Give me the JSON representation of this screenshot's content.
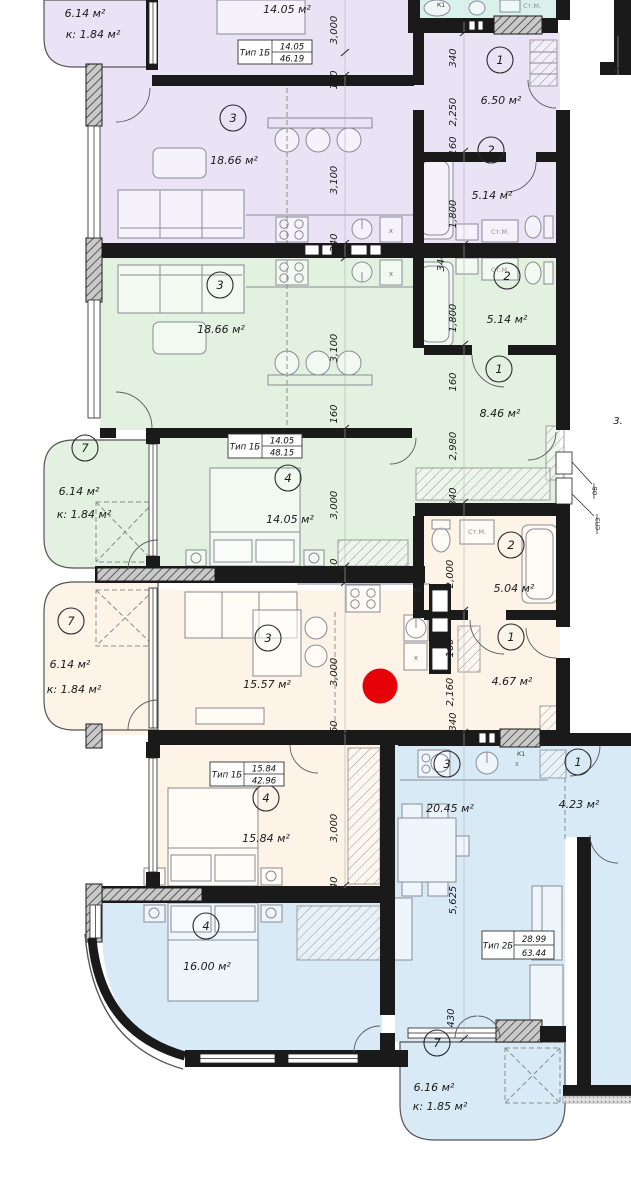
{
  "marker": {
    "color": "#e60008"
  },
  "palette": {
    "purple": "#eae3f6",
    "teal": "#daf0ea",
    "green": "#e3f1e1",
    "cream": "#fdf3e7",
    "blue": "#d9eaf7",
    "wall": "#1a1a1a"
  },
  "apartments": {
    "purple": {
      "type_table": {
        "name": "Тип 1Б",
        "area": "14.05",
        "total": "46.19"
      },
      "rooms": {
        "bedroom": {
          "area": "14.05 м²"
        },
        "living": {
          "num": "3",
          "area": "18.66 м²"
        },
        "hall": {
          "num": "1",
          "area": "6.50 м²"
        },
        "bath": {
          "num": "2",
          "area": "5.14 м²"
        }
      },
      "balcony": {
        "area": "6.14 м²",
        "coef": "к: 1.84 м²"
      }
    },
    "green": {
      "type_table": {
        "name": "Тип 1Б",
        "area": "14.05",
        "total": "48.15"
      },
      "rooms": {
        "living": {
          "num": "3",
          "area": "18.66 м²"
        },
        "bath": {
          "num": "2",
          "area": "5.14 м²"
        },
        "hall": {
          "num": "1",
          "area": "8.46 м²"
        },
        "bedroom": {
          "num": "4",
          "area": "14.05 м²"
        }
      },
      "balcony": {
        "num": "7",
        "area": "6.14 м²",
        "coef": "к: 1.84 м²"
      }
    },
    "cream": {
      "type_table": {
        "name": "Тип 1Б",
        "area": "15.84",
        "total": "42.96"
      },
      "rooms": {
        "living": {
          "num": "3",
          "area": "15.57 м²"
        },
        "bath": {
          "num": "2",
          "area": "5.04 м²"
        },
        "hall": {
          "num": "1",
          "area": "4.67 м²"
        },
        "bedroom": {
          "num": "4",
          "area": "15.84 м²"
        }
      },
      "balcony": {
        "num": "7",
        "area": "6.14 м²",
        "coef": "к: 1.84 м²"
      }
    },
    "blue": {
      "type_table": {
        "name": "Тип 2Б",
        "area": "28.99",
        "total": "63.44"
      },
      "rooms": {
        "bedroom": {
          "num": "4",
          "area": "16.00 м²"
        },
        "living": {
          "num": "3",
          "area": "20.45 м²"
        },
        "hall": {
          "num": "1",
          "area": "4.23 м²"
        }
      },
      "balcony": {
        "num": "7",
        "area": "6.16 м²",
        "coef": "к: 1.85 м²"
      }
    }
  },
  "labels": {
    "stm": "Ст.М.",
    "k1": "К1",
    "ov": "ОВ",
    "spz": "СПЗ",
    "x": "х"
  },
  "dims": [
    "3,000",
    "160",
    "3,100",
    "340",
    "3,100",
    "160",
    "3,000",
    "340",
    "3,000",
    "160",
    "3,000",
    "340",
    "340",
    "2,250",
    "160",
    "1,800",
    "340",
    "1,800",
    "160",
    "2,980",
    "340",
    "2,000",
    "160",
    "2,160",
    "340",
    "5,625",
    "430",
    "290",
    "3."
  ]
}
